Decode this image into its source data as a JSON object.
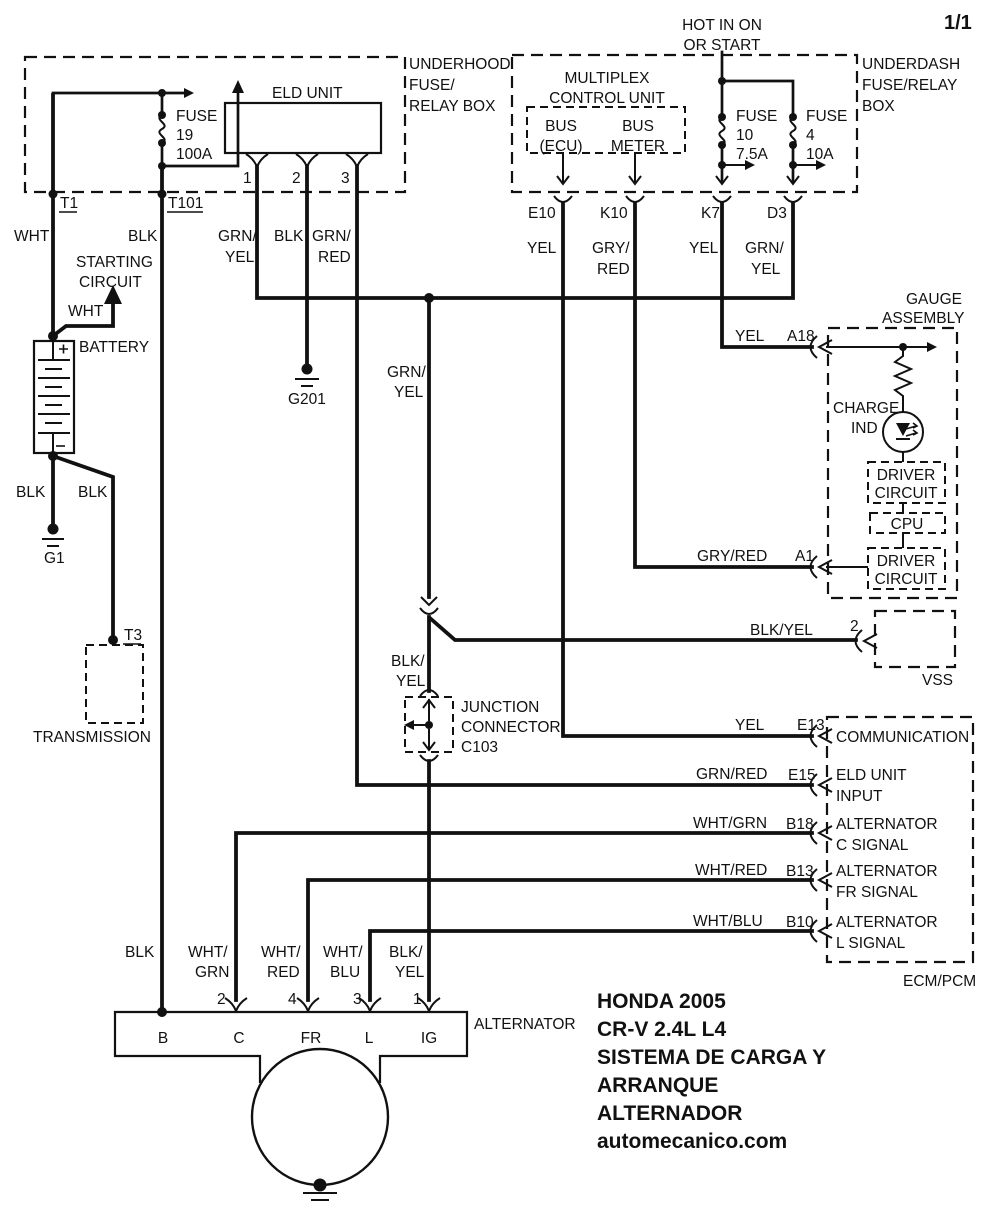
{
  "colors": {
    "ink": "#111111",
    "background": "#ffffff"
  },
  "page_number": "1/1",
  "underhood": {
    "name": [
      "UNDERHOOD",
      "FUSE/",
      "RELAY BOX"
    ],
    "fuse19": [
      "FUSE",
      "19",
      "100A"
    ],
    "eld_unit": "ELD UNIT",
    "t1": "T1",
    "t101": "T101",
    "pins": [
      "1",
      "2",
      "3"
    ]
  },
  "underdash": {
    "hot": [
      "HOT IN ON",
      "OR START"
    ],
    "name": [
      "UNDERDASH",
      "FUSE/RELAY",
      "BOX"
    ],
    "multiplex": [
      "MULTIPLEX",
      "CONTROL UNIT"
    ],
    "bus_ecu": [
      "BUS",
      "(ECU)"
    ],
    "bus_meter": [
      "BUS",
      "METER"
    ],
    "fuse10": [
      "FUSE",
      "10",
      "7.5A"
    ],
    "fuse4": [
      "FUSE",
      "4",
      "10A"
    ],
    "pins": [
      "E10",
      "K10",
      "K7",
      "D3"
    ]
  },
  "wire_labels": {
    "t1": "WHT",
    "t101": "BLK",
    "eld1": [
      "GRN/",
      "YEL"
    ],
    "eld2": "BLK",
    "eld3": [
      "GRN/",
      "RED"
    ],
    "e10": "YEL",
    "k10": [
      "GRY/",
      "RED"
    ],
    "k7": "YEL",
    "d3": [
      "GRN/",
      "YEL"
    ],
    "starting": "WHT",
    "battery_g1": "BLK",
    "battery_t3": "BLK",
    "mid": [
      "GRN/",
      "YEL"
    ],
    "c103": [
      "BLK/",
      "YEL"
    ],
    "a18": "YEL",
    "a1": "GRY/RED",
    "vss": "BLK/YEL",
    "e13": "YEL",
    "e15": "GRN/RED",
    "b18": "WHT/GRN",
    "b13": "WHT/RED",
    "b10": "WHT/BLU",
    "alt_b": "BLK",
    "alt_c": [
      "WHT/",
      "GRN"
    ],
    "alt_fr": [
      "WHT/",
      "RED"
    ],
    "alt_l": [
      "WHT/",
      "BLU"
    ],
    "alt_ig": [
      "BLK/",
      "YEL"
    ]
  },
  "components": {
    "starting_circuit": [
      "STARTING",
      "CIRCUIT"
    ],
    "battery": "BATTERY",
    "g1": "G1",
    "g201": "G201",
    "t3": "T3",
    "transmission": "TRANSMISSION",
    "junction_connector": [
      "JUNCTION",
      "CONNECTOR",
      "C103"
    ],
    "gauge_assembly": [
      "GAUGE",
      "ASSEMBLY"
    ],
    "charge_ind": [
      "CHARGE",
      "IND"
    ],
    "driver_circuit": [
      "DRIVER",
      "CIRCUIT"
    ],
    "cpu": "CPU",
    "vss": "VSS",
    "ecm_pcm": "ECM/PCM",
    "alternator": "ALTERNATOR"
  },
  "pins": {
    "a18": "A18",
    "a1": "A1",
    "vss2": "2",
    "e13": "E13",
    "e15": "E15",
    "b18": "B18",
    "b13": "B13",
    "b10": "B10",
    "alt": [
      "2",
      "4",
      "3",
      "1"
    ],
    "alt_terminals": [
      "B",
      "C",
      "FR",
      "L",
      "IG"
    ]
  },
  "ecm_labels": {
    "e13": [
      "COMMUNICATION"
    ],
    "e15": [
      "ELD UNIT",
      "INPUT"
    ],
    "b18": [
      "ALTERNATOR",
      "C SIGNAL"
    ],
    "b13": [
      "ALTERNATOR",
      "FR SIGNAL"
    ],
    "b10": [
      "ALTERNATOR",
      "L SIGNAL"
    ]
  },
  "title_block": [
    "HONDA 2005",
    "CR-V 2.4L L4",
    "SISTEMA DE CARGA Y",
    "ARRANQUE",
    "ALTERNADOR",
    "automecanico.com"
  ]
}
